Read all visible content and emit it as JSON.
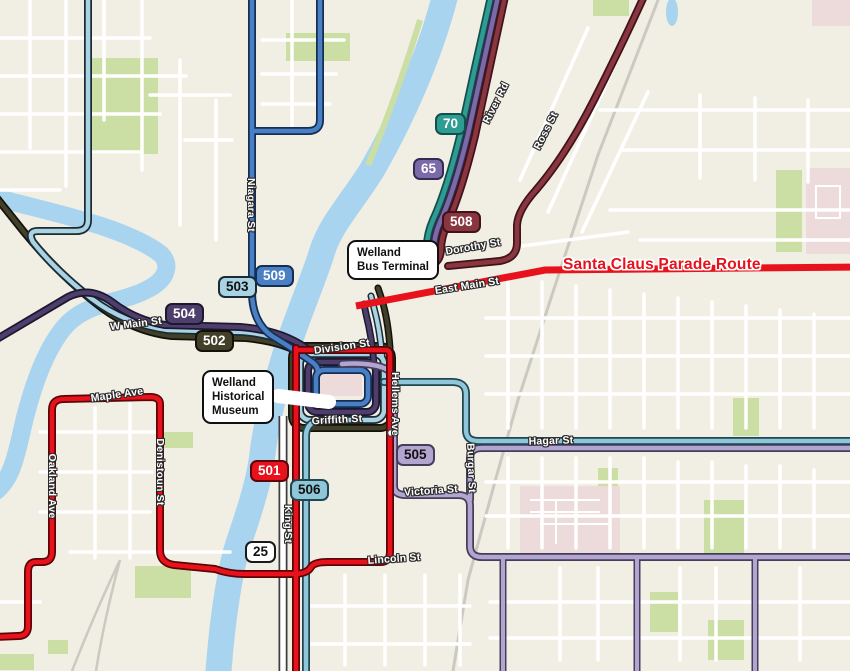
{
  "map_title": "Welland downtown transit routes map",
  "colors": {
    "land": "#f1eee4",
    "water": "#a8d4f0",
    "park": "#cbdfa5",
    "plaza_pink": "#ecdbda",
    "parade_red": "#e8121c",
    "route_70": "#2f9c94",
    "route_65": "#7b6aa8",
    "route_508": "#8a3640",
    "route_509": "#4a7fc4",
    "route_503": "#a9d2e3",
    "route_504": "#4e3e6b",
    "route_502": "#43402a",
    "route_501": "#e8121c",
    "route_506": "#8fc7d9",
    "route_505": "#b2a5d0"
  },
  "streets": [
    {
      "name": "Niagara St"
    },
    {
      "name": "River Rd"
    },
    {
      "name": "Ross St"
    },
    {
      "name": "Dorothy St"
    },
    {
      "name": "East Main St"
    },
    {
      "name": "W Main St"
    },
    {
      "name": "Division St"
    },
    {
      "name": "Griffith St"
    },
    {
      "name": "Hellems Ave"
    },
    {
      "name": "King St"
    },
    {
      "name": "Maple Ave"
    },
    {
      "name": "Oakland Ave"
    },
    {
      "name": "Denistoun St"
    },
    {
      "name": "Victoria St"
    },
    {
      "name": "Lincoln St"
    },
    {
      "name": "Hagar St"
    },
    {
      "name": "Burgar St"
    }
  ],
  "badges": [
    {
      "number": "70",
      "bg": "#2f9c94",
      "fg": "#ffffff",
      "border": "#12514b"
    },
    {
      "number": "65",
      "bg": "#7b6aa8",
      "fg": "#ffffff",
      "border": "#352a52"
    },
    {
      "number": "508",
      "bg": "#8a3640",
      "fg": "#ffffff",
      "border": "#3f1318"
    },
    {
      "number": "503",
      "bg": "#a9d2e3",
      "fg": "#111111",
      "border": "#1b2b33"
    },
    {
      "number": "509",
      "bg": "#4a7fc4",
      "fg": "#ffffff",
      "border": "#142f55"
    },
    {
      "number": "504",
      "bg": "#4e3e6b",
      "fg": "#ffffff",
      "border": "#1d1730"
    },
    {
      "number": "502",
      "bg": "#43402a",
      "fg": "#ffffff",
      "border": "#13120a"
    },
    {
      "number": "501",
      "bg": "#e8121c",
      "fg": "#ffffff",
      "border": "#5c0508"
    },
    {
      "number": "506",
      "bg": "#8fc7d9",
      "fg": "#111111",
      "border": "#1f4653"
    },
    {
      "number": "505",
      "bg": "#b2a5d0",
      "fg": "#111111",
      "border": "#463d5c"
    },
    {
      "number": "25",
      "bg": "#ffffff",
      "fg": "#111111",
      "border": "#1a1a1a"
    }
  ],
  "callouts": {
    "terminal": {
      "line1": "Welland",
      "line2": "Bus Terminal"
    },
    "museum": {
      "line1": "Welland",
      "line2": "Historical",
      "line3": "Museum"
    }
  },
  "parade_route_label": "Santa Claus Parade Route"
}
